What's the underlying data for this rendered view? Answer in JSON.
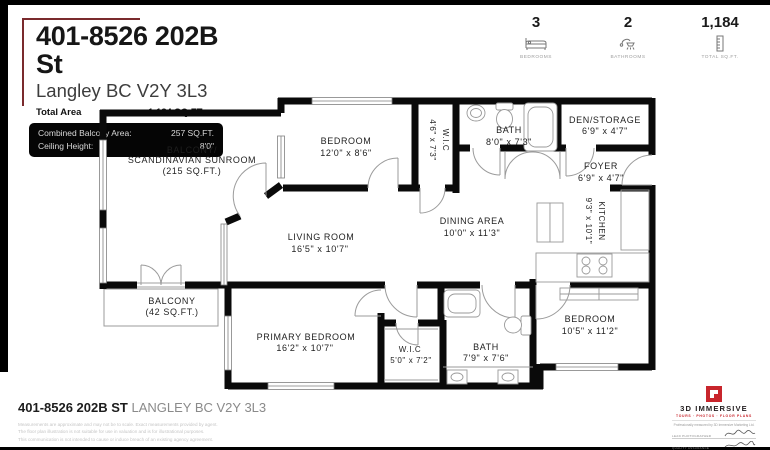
{
  "header": {
    "address": "401-8526 202B St",
    "city": "Langley BC V2Y 3L3",
    "total_area_label": "Total Area",
    "total_area_value": "1,184 SQ.FT.",
    "balcony_area_label": "Combined Balcony Area:",
    "balcony_area_value": "257 SQ.FT.",
    "ceiling_label": "Ceiling Height:",
    "ceiling_value": "8'0\""
  },
  "stats": {
    "bedrooms": {
      "value": "3",
      "label": "BEDROOMS"
    },
    "bathrooms": {
      "value": "2",
      "label": "BATHROOMS"
    },
    "total_sqft": {
      "value": "1,184",
      "label": "TOTAL SQ.FT."
    }
  },
  "rooms": {
    "sunroom": {
      "l1": "BALCONY/",
      "l2": "SCANDINAVIAN SUNROOM",
      "l3": "(215 SQ.FT.)"
    },
    "bedroom2": {
      "name": "BEDROOM",
      "dims": "12'0\" x 8'6\""
    },
    "wic2": {
      "name": "W.I.C",
      "dims": "4'6\" x 7'3\""
    },
    "bath2": {
      "name": "BATH",
      "dims": "8'0\" x 7'3\""
    },
    "den": {
      "name": "DEN/STORAGE",
      "dims": "6'9\" x 4'7\""
    },
    "foyer": {
      "name": "FOYER",
      "dims": "6'9\" x 4'7\""
    },
    "kitchen": {
      "name": "KITCHEN",
      "dims": "9'3\" x 10'1\""
    },
    "dining": {
      "name": "DINING AREA",
      "dims": "10'0\" x 11'3\""
    },
    "living": {
      "name": "LIVING ROOM",
      "dims": "16'5\" x 10'7\""
    },
    "balcony": {
      "name": "BALCONY",
      "dims": "(42 SQ.FT.)"
    },
    "primary": {
      "name": "PRIMARY BEDROOM",
      "dims": "16'2\" x 10'7\""
    },
    "wic1": {
      "name": "W.I.C",
      "dims": "5'0\" x 7'2\""
    },
    "bath1": {
      "name": "BATH",
      "dims": "7'9\" x 7'6\""
    },
    "bedroom3": {
      "name": "BEDROOM",
      "dims": "10'5\" x 11'2\""
    }
  },
  "footer": {
    "address_bold": "401-8526 202B ST",
    "address_rest": " LANGLEY BC V2Y 3L3",
    "disclaimer_line1": "Measurements are approximate and may not be to scale. Exact measurements provided by agent.",
    "disclaimer_line2": "The floor plan illustration is not suitable for use in valuation and is for illustrational purposes.",
    "disclaimer_line3": "This communication is not intended to cause or induce breach of an existing agency agreement."
  },
  "brand": {
    "name": "3D IMMERSIVE",
    "tagline": "TOURS · PHOTOS · FLOOR PLANS",
    "measured_by": "Professionally measured by 3D Immersive Marketing Ltd.",
    "sig1_label": "Lead Photographer",
    "sig2_label": "Quality Assurance"
  },
  "colors": {
    "wall_black": "#0a0a0a",
    "accent_red": "#c8252c",
    "bracket_maroon": "#7a2a2d",
    "spec_box_bg": "#050505"
  }
}
